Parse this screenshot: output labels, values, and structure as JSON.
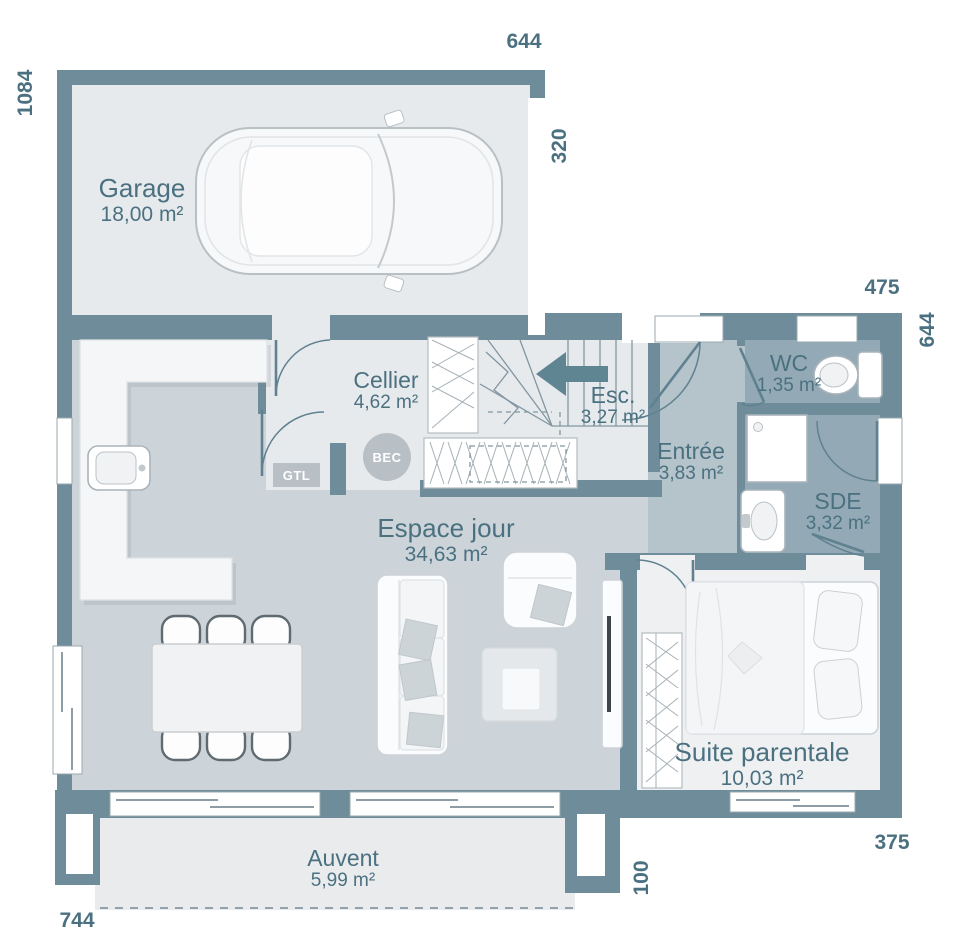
{
  "rooms": {
    "garage": {
      "name": "Garage",
      "area": "18,00 m²"
    },
    "cellier": {
      "name": "Cellier",
      "area": "4,62 m²"
    },
    "esc": {
      "name": "Esc.",
      "area": "3,27 m²"
    },
    "entree": {
      "name": "Entrée",
      "area": "3,83 m²"
    },
    "wc": {
      "name": "WC",
      "area": "1,35 m²"
    },
    "sde": {
      "name": "SDE",
      "area": "3,32 m²"
    },
    "espace_jour": {
      "name": "Espace jour",
      "area": "34,63 m²"
    },
    "suite": {
      "name": "Suite parentale",
      "area": "10,03 m²"
    },
    "auvent": {
      "name": "Auvent",
      "area": "5,99 m²"
    }
  },
  "dims": {
    "top": "644",
    "garage_side": "320",
    "left": "1084",
    "top_right": "475",
    "right": "644",
    "bottom_right": "375",
    "auvent_depth": "100",
    "bottom": "744"
  },
  "tags": {
    "gtl": "GTL",
    "bec": "BEC"
  },
  "colors": {
    "wall": "#6e8c9a",
    "floor_light": "#e7eaed",
    "floor_main": "#ccd4da",
    "floor_entree": "#b5c3cb",
    "floor_wet": "#93aab6",
    "floor_suite": "#eef0f2",
    "floor_auvent": "#e9ebed",
    "text": "#4b7181",
    "tag_gray": "#b8bfc5",
    "door": "#5f8190",
    "stair": "#8296a1"
  }
}
